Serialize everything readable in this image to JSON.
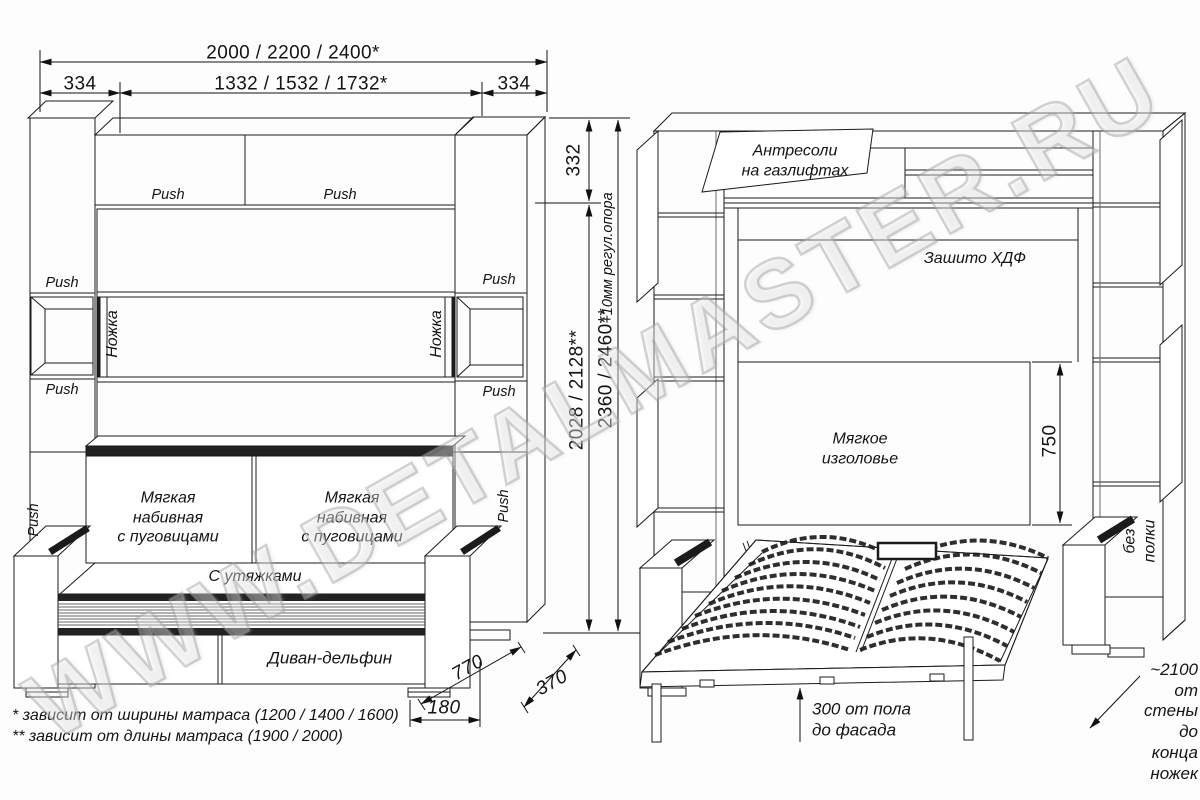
{
  "watermark": {
    "text": "WWW.DETALMASTER.RU"
  },
  "dims": {
    "total_width": "2000 / 2200 / 2400*",
    "side_width_left": "334",
    "inner_width": "1332 / 1532 / 1732*",
    "side_width_right": "334",
    "top_height": "332",
    "inner_height": "2028 / 2128**",
    "total_height": "2360 / 2460**",
    "support_note": "+10мм регул.опора",
    "sofa_depth": "770",
    "extra_depth": "370",
    "plinth_depth": "180",
    "headboard_height": "750",
    "floor_to_facade": "300 от пола\nдо фасада",
    "wall_to_legs": "~2100\nот стены\nдо конца ножек"
  },
  "left_view": {
    "push": "Push",
    "leg_label": "Ножка",
    "cushion_label": "Мягкая\nнабивная\nс пуговицами",
    "straps_label": "С утяжками",
    "base_label": "Диван-дельфин"
  },
  "right_view": {
    "flap_label": "Антресоли\nна газлифтах",
    "back_panel_label": "Зашито ХДФ",
    "headboard_label": "Мягкое\nизголовье",
    "no_shelf_label": "без полки"
  },
  "footnotes": {
    "first": "* зависит от ширины матраса (1200 / 1400 / 1600)",
    "second": "** зависит от длины матраса (1900 / 2000)"
  }
}
